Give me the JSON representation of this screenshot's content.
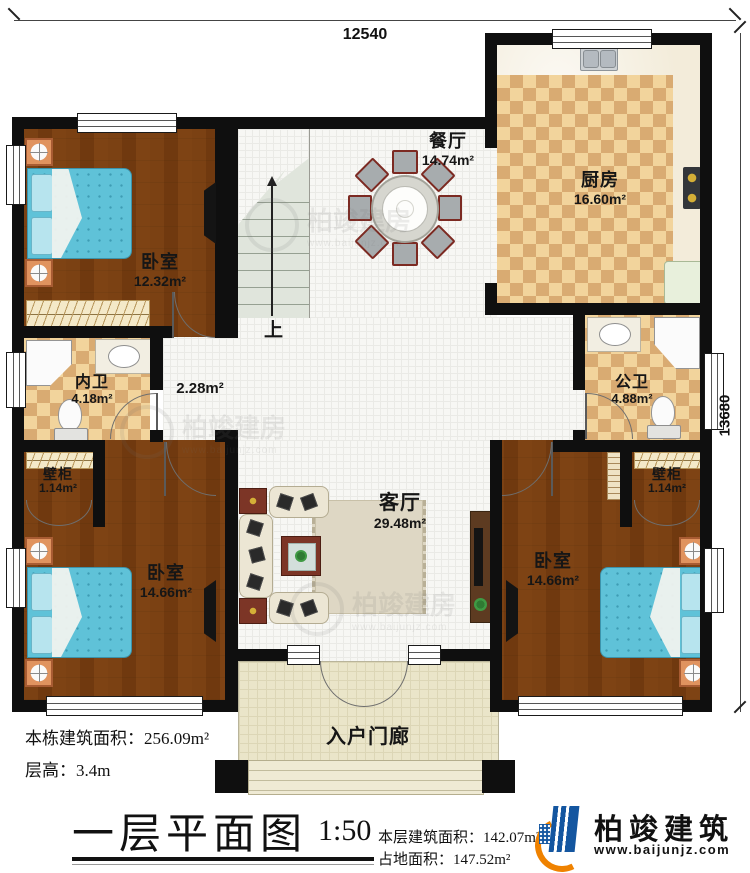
{
  "dim": {
    "top": "12540",
    "right": "13680"
  },
  "rooms": {
    "bedroom_tl": {
      "name": "卧室",
      "area": "12.32m²"
    },
    "dining": {
      "name": "餐厅",
      "area": "14.74m²"
    },
    "kitchen": {
      "name": "厨房",
      "area": "16.60m²"
    },
    "bath_inner": {
      "name": "内卫",
      "area": "4.18m²"
    },
    "bath_public": {
      "name": "公卫",
      "area": "4.88m²"
    },
    "hallway": {
      "area": "2.28m²"
    },
    "closet_left": {
      "name": "壁柜",
      "area": "1.14m²"
    },
    "closet_right": {
      "name": "壁柜",
      "area": "1.14m²"
    },
    "bedroom_bl": {
      "name": "卧室",
      "area": "14.66m²"
    },
    "bedroom_br": {
      "name": "卧室",
      "area": "14.66m²"
    },
    "living": {
      "name": "客厅",
      "area": "29.48m²"
    },
    "porch": {
      "name": "入户门廊"
    },
    "stairs": {
      "up_label": "上"
    }
  },
  "footer": {
    "building_area_label": "本栋建筑面积：",
    "building_area_value": "256.09m²",
    "floor_height_label": "层高：",
    "floor_height_value": "3.4m",
    "plan_title": "一层平面图",
    "scale": "1:50",
    "floor_area_label": "本层建筑面积：",
    "floor_area_value": "142.07m²",
    "land_area_label": "占地面积：",
    "land_area_value": "147.52m²"
  },
  "brand": {
    "name": "柏竣建筑",
    "website": "www.baijunjz.com"
  },
  "watermark": {
    "text": "柏竣建房",
    "url": "www.baijunjz.com"
  }
}
